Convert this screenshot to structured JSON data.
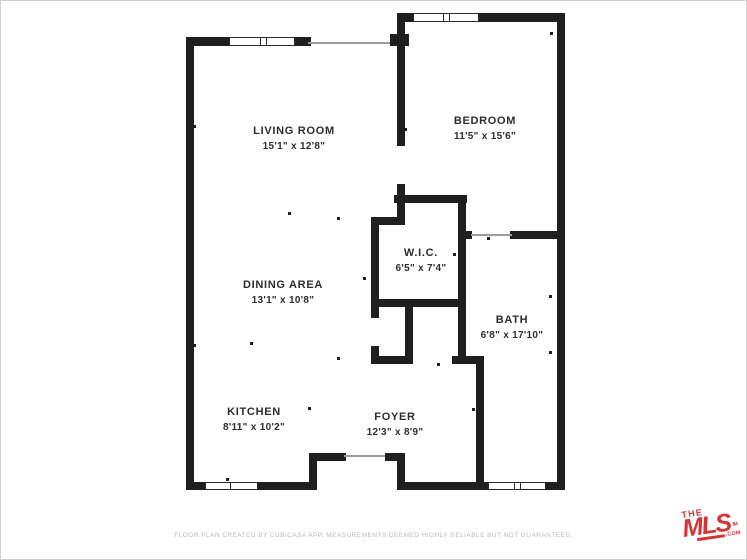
{
  "page": {
    "background_color": "#ffffff",
    "border_color": "#cfcfcf",
    "wall_color": "#1f1f1f",
    "text_color": "#2d2d2d",
    "accent_color": "#d63434"
  },
  "floor_plan": {
    "rooms": [
      {
        "id": "living-room",
        "name": "LIVING ROOM",
        "dimensions": "15'1\" x 12'8\""
      },
      {
        "id": "bedroom",
        "name": "BEDROOM",
        "dimensions": "11'5\" x 15'6\""
      },
      {
        "id": "wic",
        "name": "W.I.C.",
        "dimensions": "6'5\" x 7'4\""
      },
      {
        "id": "dining-area",
        "name": "DINING AREA",
        "dimensions": "13'1\" x 10'8\""
      },
      {
        "id": "bath",
        "name": "BATH",
        "dimensions": "6'8\" x 17'10\""
      },
      {
        "id": "kitchen",
        "name": "KITCHEN",
        "dimensions": "8'11\" x 10'2\""
      },
      {
        "id": "foyer",
        "name": "FOYER",
        "dimensions": "12'3\" x 8'9\""
      }
    ]
  },
  "footer": {
    "disclaimer": "FLOOR PLAN CREATED BY CUBICASA APP. MEASUREMENTS DEEMED HIGHLY RELIABLE BUT NOT GUARANTEED."
  },
  "logo": {
    "the": "THE",
    "mls": "MLS",
    "com": ".COM",
    "tm": "TM"
  }
}
